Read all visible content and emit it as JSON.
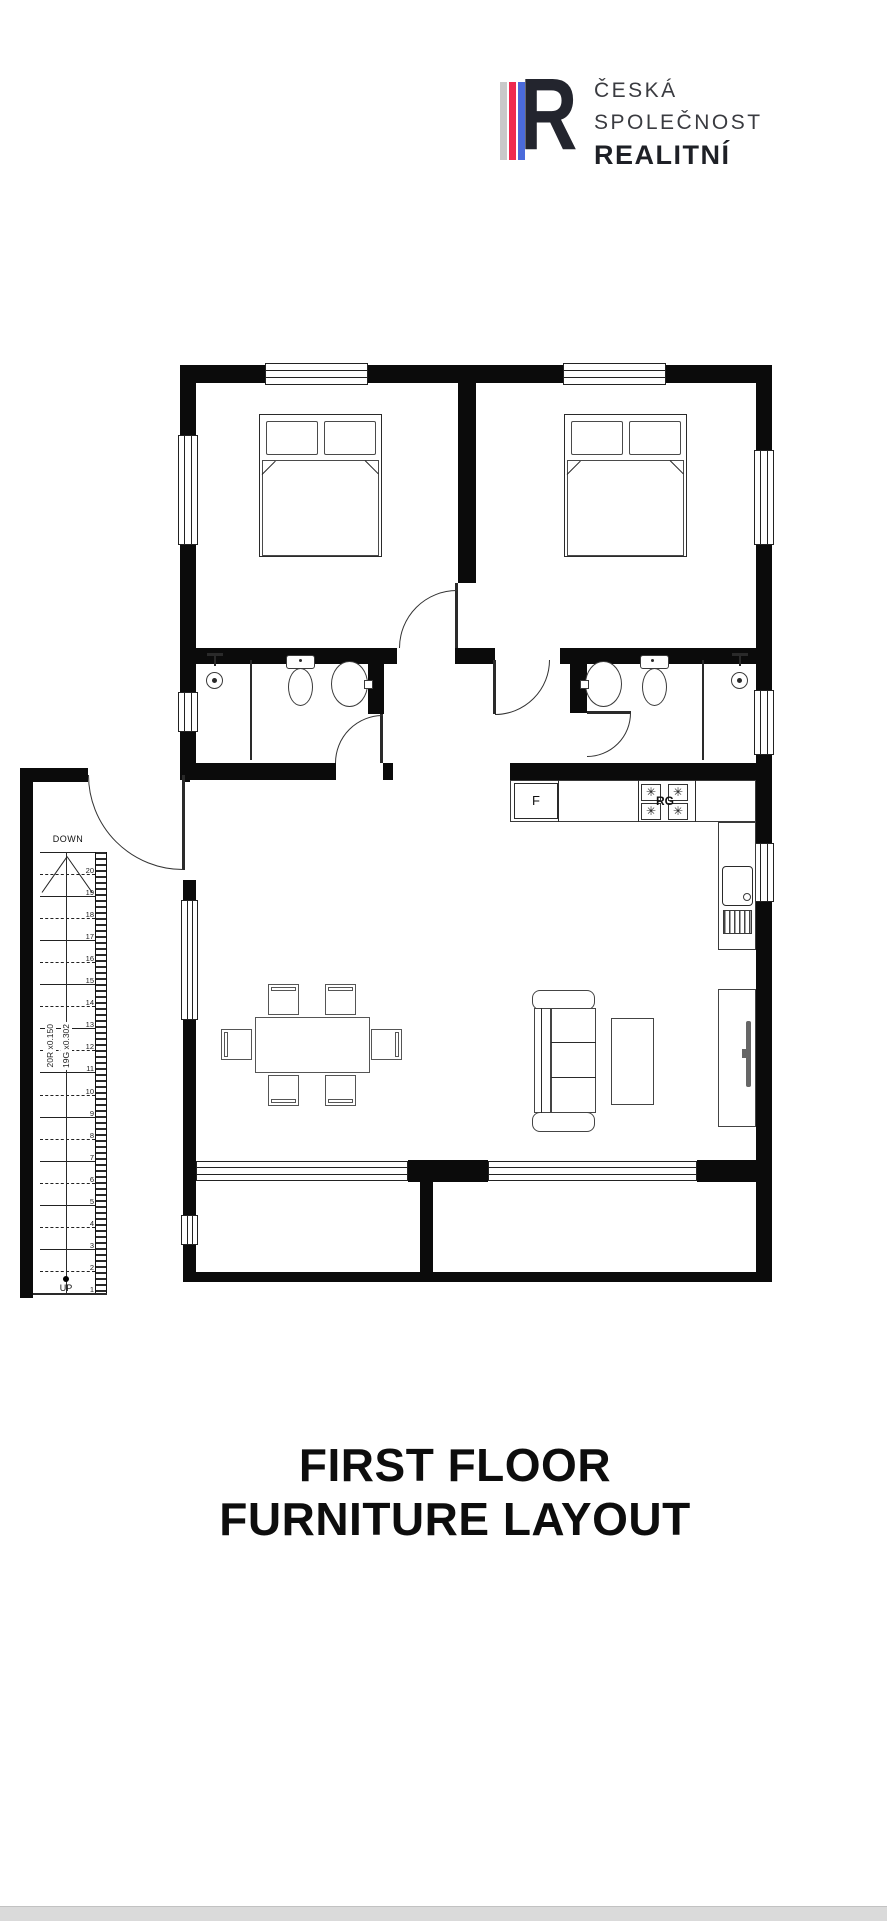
{
  "logo": {
    "letter": "R",
    "line1": "ČESKÁ",
    "line2": "SPOLEČNOST",
    "line3": "REALITNÍ",
    "bar_gray": "#c9c9c9",
    "bar_red": "#ee2b50",
    "bar_blue": "#4b6bdb",
    "letter_color": "#23252e"
  },
  "title": {
    "line1": "FIRST FLOOR",
    "line2": "FURNITURE LAYOUT"
  },
  "floor_plan": {
    "labels": {
      "down": "DOWN",
      "up": "UP",
      "fridge": "F",
      "range": "RG",
      "risers": "20R x0.150",
      "goings": "19G x0.302"
    },
    "burner_glyph": "✳",
    "stair_numbers": [
      "20",
      "19",
      "18",
      "17",
      "16",
      "15",
      "14",
      "13",
      "12",
      "11",
      "10",
      "9",
      "8",
      "7",
      "6",
      "5",
      "4",
      "3",
      "2",
      "1"
    ]
  }
}
